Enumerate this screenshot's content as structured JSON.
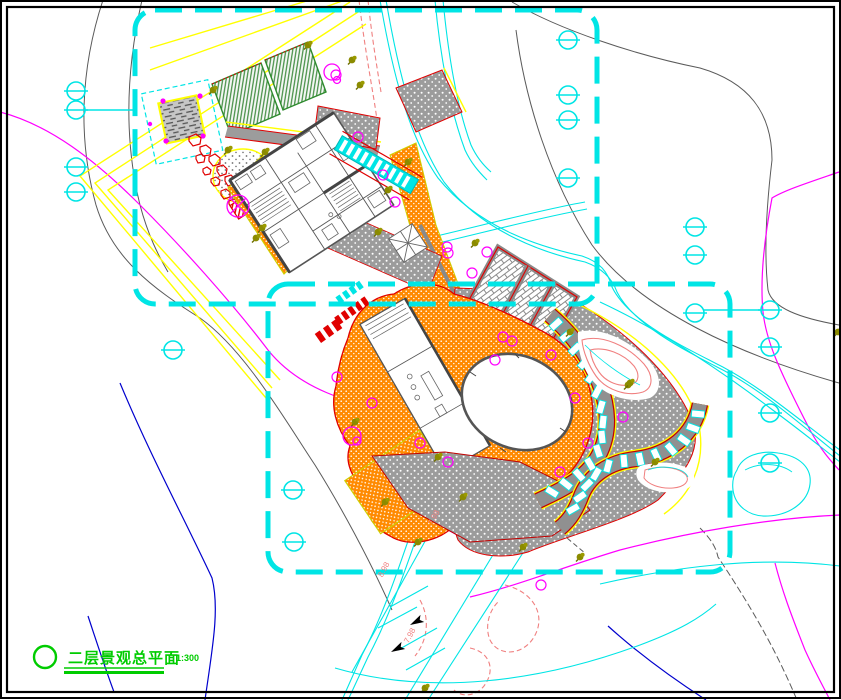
{
  "drawing": {
    "title": "二层景观总平面",
    "scale": "1:300",
    "elevation_labels": [
      {
        "text": "7.98"
      },
      {
        "text": "8.98"
      },
      {
        "text": "7.98"
      }
    ]
  },
  "colors": {
    "boundary_dash": "#00FFFF",
    "paving_orange": "#FF8A00",
    "road_yellow": "#FFFF00",
    "planting_green": "#2E8B2E",
    "contour_magenta": "#FF00FF",
    "contour_salmon": "#F08080",
    "water_blue": "#0000CD",
    "edge_red": "#E00000",
    "plaza_gray": "#9C9C9C",
    "tree_olive": "#808000",
    "title_green": "#00CC00"
  },
  "symbols": {
    "benchmark": "benchmark-marker",
    "tree_olive": "tree-icon",
    "tree_shrub": "shrub-icon",
    "north_arrow": "flow-arrow-icon"
  }
}
